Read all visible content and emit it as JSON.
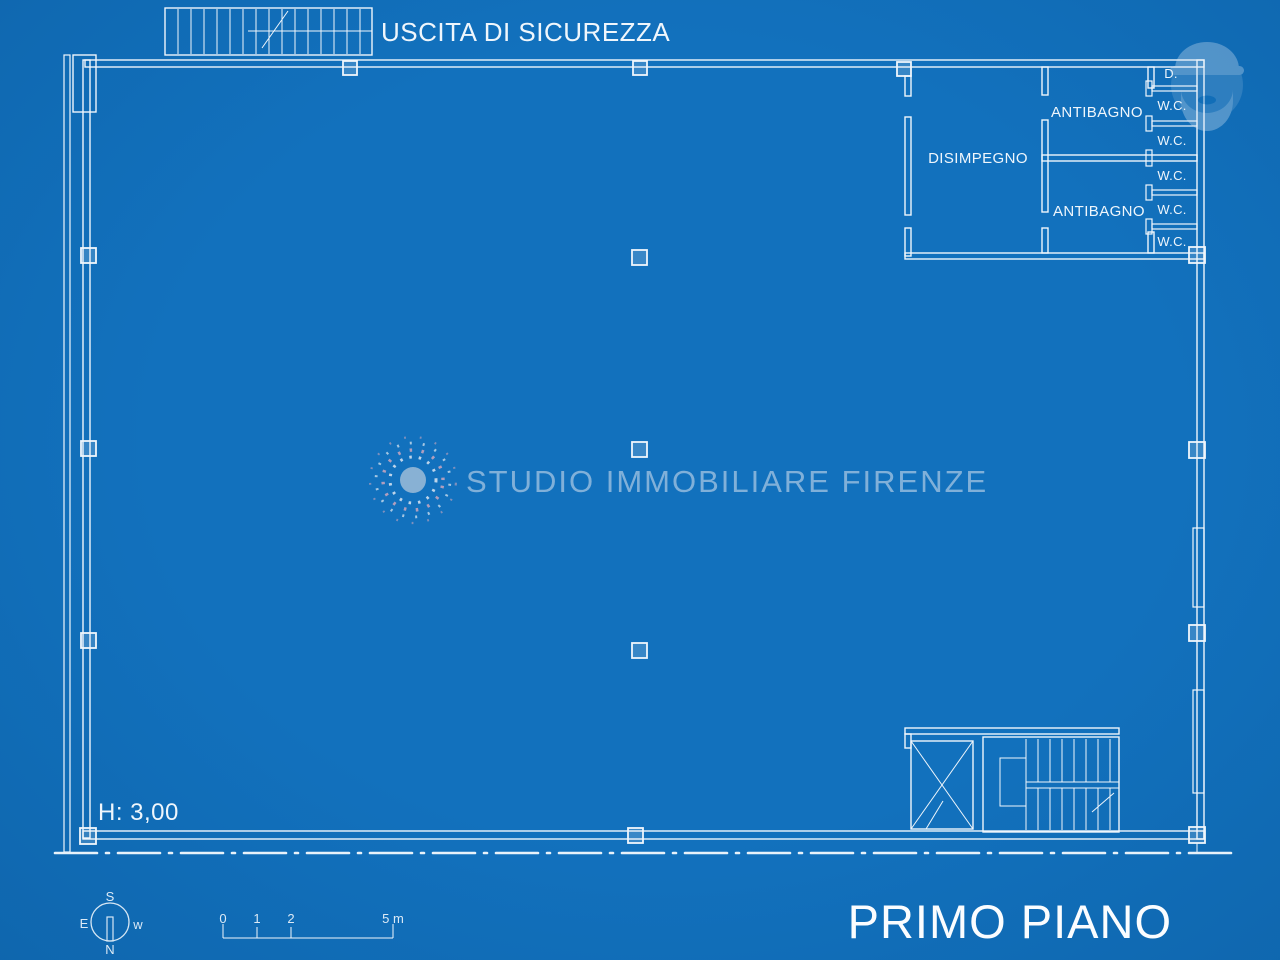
{
  "colors": {
    "background": "#1271BD",
    "line": "#EFF6FC",
    "muted": "#9CC0E0",
    "accent_pink": "#D8AABE"
  },
  "plan": {
    "safety_exit_label": "USCITA DI SICUREZZA",
    "height_label": "H: 3,00",
    "floor_label": "PRIMO PIANO",
    "rooms": {
      "disimpegno": "DISIMPEGNO",
      "antibagno_top": "ANTIBAGNO",
      "antibagno_bottom": "ANTIBAGNO",
      "shower": "D.",
      "wc": [
        "W.C.",
        "W.C.",
        "W.C.",
        "W.C.",
        "W.C."
      ]
    }
  },
  "watermark": {
    "agency": "STUDIO IMMOBILIARE FIRENZE"
  },
  "compass": {
    "top": "S",
    "left": "E",
    "right": "w",
    "bottom": "N"
  },
  "scale_bar": {
    "labels": [
      "0",
      "1",
      "2",
      "5 m"
    ]
  }
}
